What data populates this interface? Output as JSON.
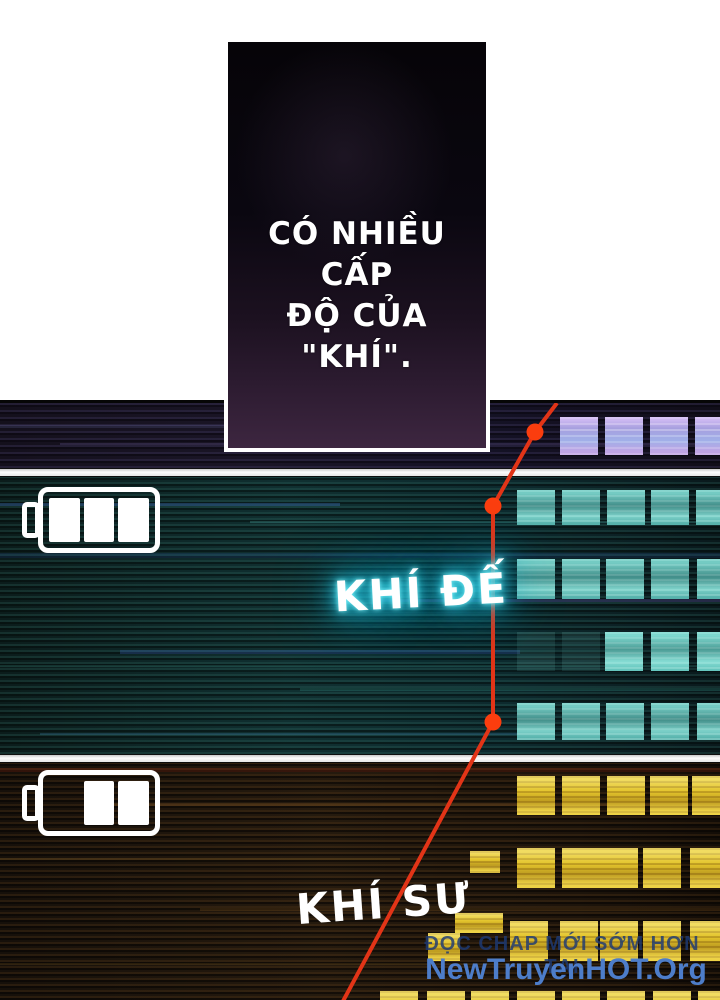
{
  "page": {
    "dialogue": {
      "line1": "CÓ NHIỀU CẤP",
      "line2": "ĐỘ CỦA \"KHÍ\"."
    },
    "levels": [
      {
        "label": "KHÍ ĐẾ",
        "battery": "3/3",
        "glow_color": "#39dff2",
        "square_color": "#57b2ac"
      },
      {
        "label": "KHÍ SƯ",
        "battery": "2/3",
        "glow_color": "#ffb81e",
        "square_color": "#e3c42c"
      }
    ],
    "top_row_square_color": "#a79fdf",
    "red_line_color": "#e23417",
    "dot_color": "#fb3d0e",
    "watermark": {
      "tagline": "ĐỌC CHAP MỚI SỚM HƠN TẠI",
      "site": "NewTruyenHOT.Org"
    }
  }
}
